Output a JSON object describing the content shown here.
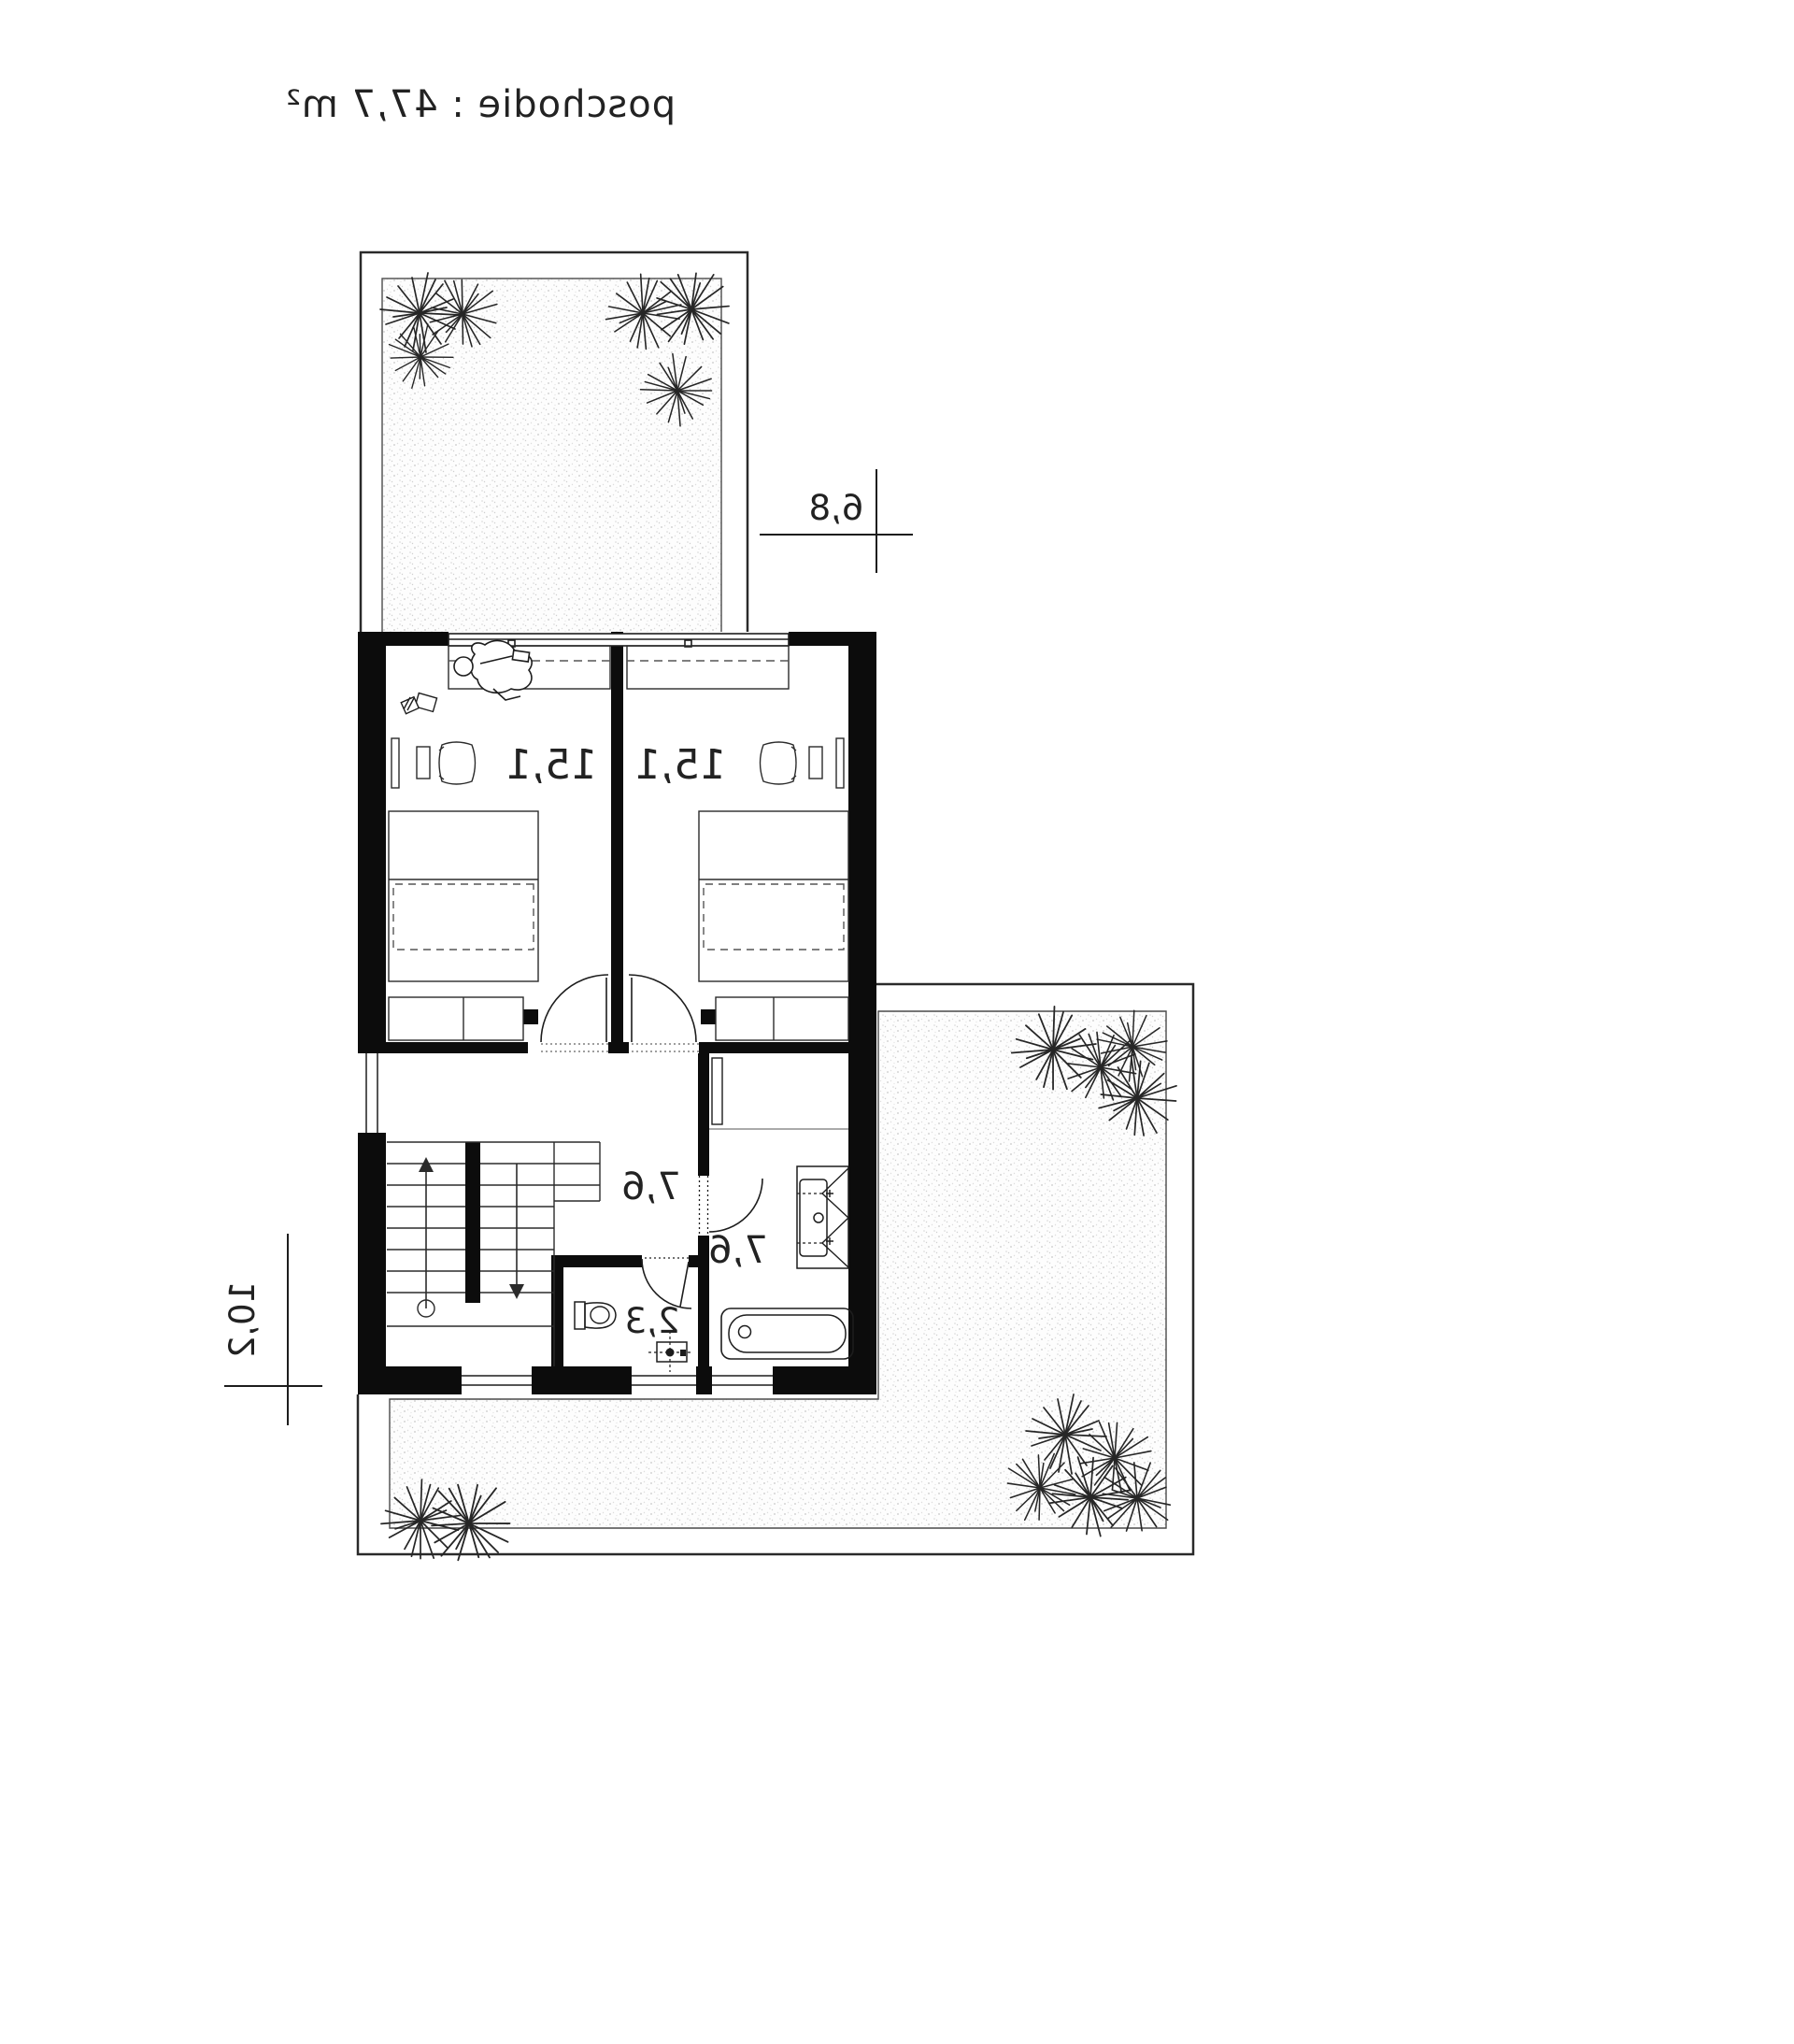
{
  "title": "poschodie : 47,7 m²",
  "rooms": {
    "bedroom_a": {
      "name": "bedroom-left",
      "area": "15,1"
    },
    "bedroom_b": {
      "name": "bedroom-right",
      "area": "15,1"
    },
    "hall": {
      "name": "hallway",
      "area": "7,6"
    },
    "bathroom": {
      "name": "bathroom",
      "area": "7,6"
    },
    "wc": {
      "name": "wc",
      "area": "2,3"
    }
  },
  "dimensions": {
    "width": {
      "label": "6,8"
    },
    "height": {
      "label": "10,2"
    }
  },
  "colors": {
    "paper": "#ffffff",
    "line": "#1d1d1d",
    "wall": "#0c0c0c",
    "stipple": "#cccccc"
  },
  "note": "floor plan rendered mirrored (scaleX -1) as in source image"
}
